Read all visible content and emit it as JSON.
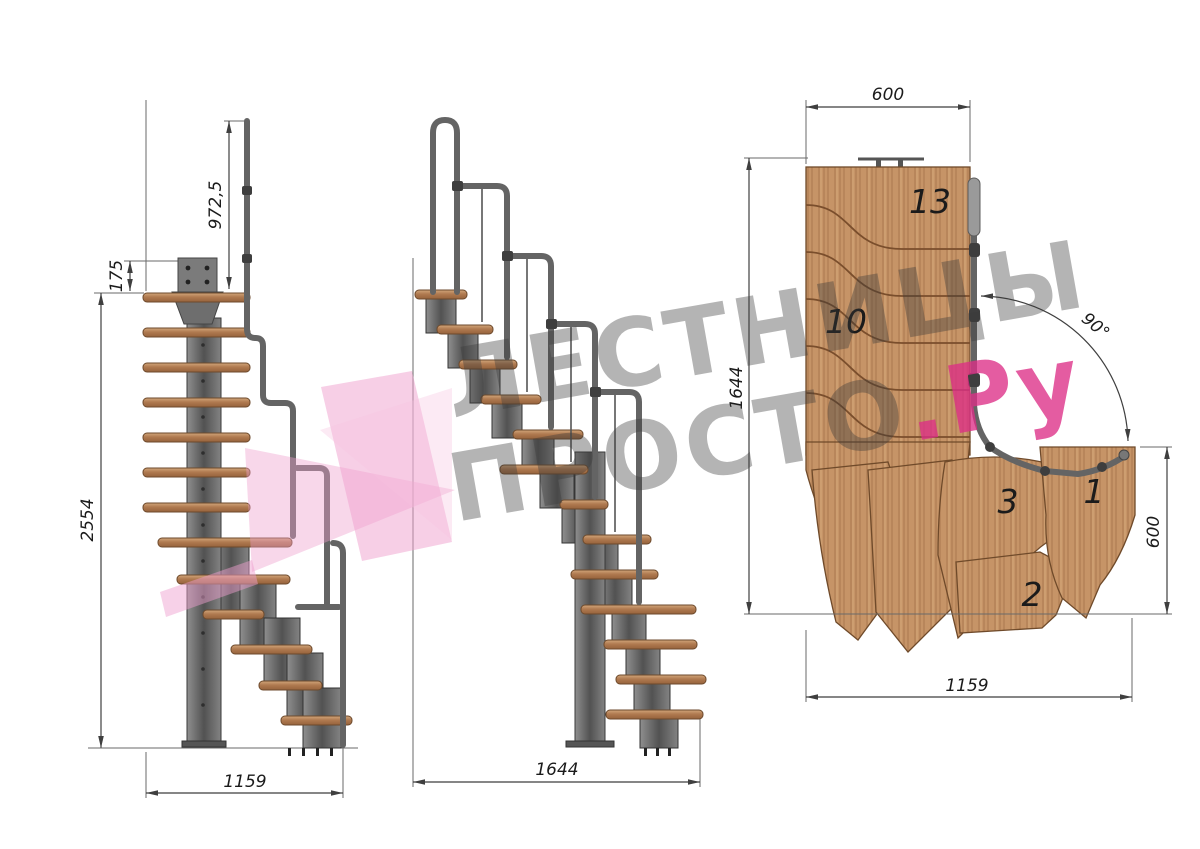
{
  "watermark": {
    "line1": "ЛЕСТНИЦЫ",
    "line2_gray": "ПРОСТО",
    "line2_pink": ".Ру"
  },
  "side_view": {
    "dim_rail_height": "972,5",
    "dim_plate_height": "175",
    "dim_total_height": "2554",
    "dim_run": "1159"
  },
  "front_view": {
    "dim_run": "1644"
  },
  "plan_view": {
    "dim_top_width": "600",
    "dim_left_length": "1644",
    "dim_turn_angle": "90°",
    "dim_right_width": "600",
    "dim_bottom_length": "1159",
    "steps": {
      "top13": "13",
      "mid10": "10",
      "n3": "3",
      "n1": "1",
      "n2": "2"
    }
  },
  "colors": {
    "wood": "#c69467",
    "tread": "#b07a50",
    "metal": "#5f5f5f",
    "dimension_lines": "#3f3f3f",
    "watermark_gray": "#9a9a9a",
    "brand_pink": "#dc2e86",
    "logo_pink": "#ef9fce"
  }
}
